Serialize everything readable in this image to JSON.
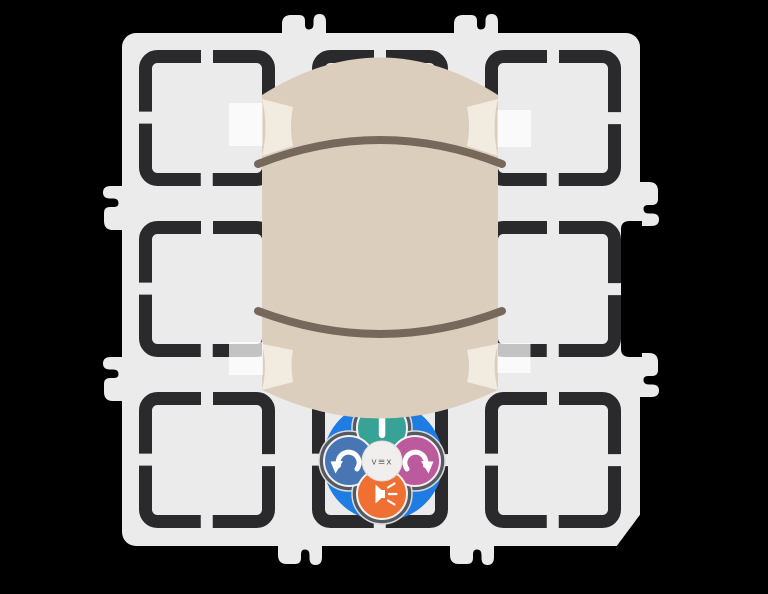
{
  "background_color": "#000000",
  "field": {
    "rows": 3,
    "cols": 3,
    "tile_color": "#EBEBEB",
    "bracket_color": "#2A2A2C",
    "tape_overlay_color": "rgba(255,255,255,0.72)"
  },
  "tube": {
    "body_color": "#DCCEBD",
    "ring_color": "#77685C",
    "tape_color": "#F2EBE0"
  },
  "robot": {
    "logo_text": "v≡x",
    "logo_color": "#63636A",
    "body_color": "#1E7CE2",
    "pad_color": "#565A60",
    "pad_outline_color": "#D8DADB",
    "center_color": "#F1EFED",
    "icon_color": "#FFFFFF",
    "buttons": [
      {
        "label": "move",
        "icon": "move-bar-icon",
        "color": "#37A295"
      },
      {
        "label": "turn-left",
        "icon": "turn-left-arrow-icon",
        "color": "#4876B5"
      },
      {
        "label": "turn-right",
        "icon": "turn-right-arrow-icon",
        "color": "#BC5A9E"
      },
      {
        "label": "sound",
        "icon": "speaker-icon",
        "color": "#F07033"
      }
    ]
  }
}
